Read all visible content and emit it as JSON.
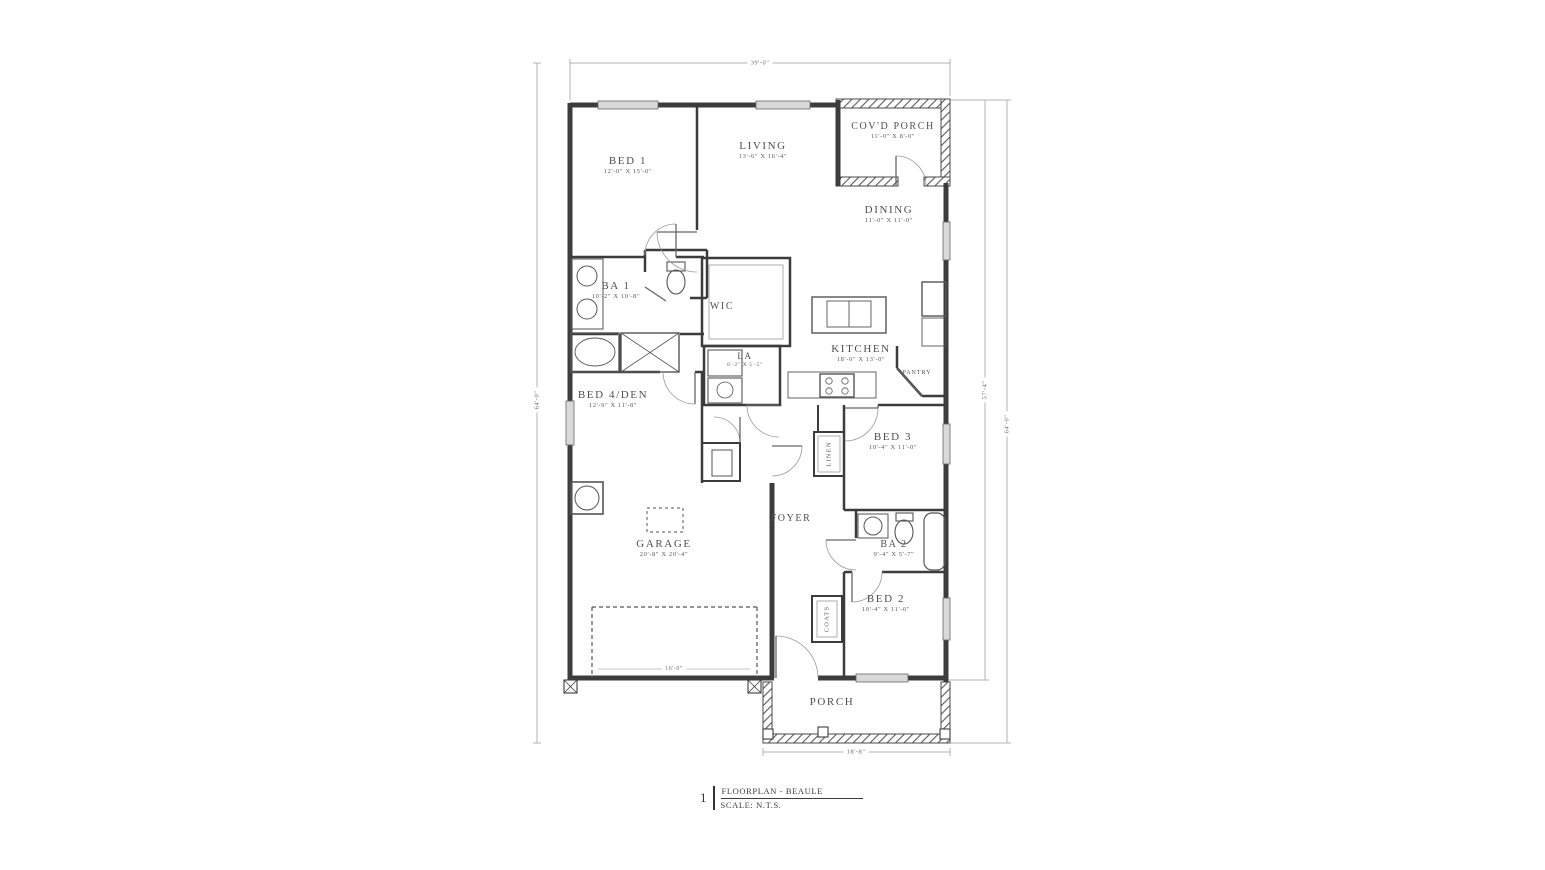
{
  "title_block": {
    "number": "1",
    "title": "FLOORPLAN - BEAULE",
    "scale": "SCALE: N.T.S."
  },
  "dimensions": {
    "top": "39'-0\"",
    "left": "64'-0\"",
    "right_inner": "57'-4\"",
    "right_outer": "64'-0\"",
    "porch_width": "18'-8\"",
    "garage_door": "16'-0\""
  },
  "rooms": {
    "bed1": {
      "name": "BED 1",
      "dims": "12'-0\" X 15'-0\""
    },
    "living": {
      "name": "LIVING",
      "dims": "13'-6\" X 16'-4\""
    },
    "covd_porch": {
      "name": "COV'D PORCH",
      "dims": "11'-0\" X 8'-0\""
    },
    "dining": {
      "name": "DINING",
      "dims": "11'-0\" X 11'-0\""
    },
    "ba1": {
      "name": "BA 1",
      "dims": "10'-2\" X 10'-8\""
    },
    "wic": {
      "name": "WIC"
    },
    "la": {
      "name": "LA",
      "dims": "6'-2\" X 5'-5\""
    },
    "kitchen": {
      "name": "KITCHEN",
      "dims": "18'-0\" X 13'-0\""
    },
    "pantry": {
      "name": "PANTRY"
    },
    "bed4": {
      "name": "BED 4/DEN",
      "dims": "12'-9\" X 11'-8\""
    },
    "bed3": {
      "name": "BED 3",
      "dims": "10'-4\" X 11'-0\""
    },
    "linen": {
      "name": "LINEN"
    },
    "foyer": {
      "name": "FOYER"
    },
    "garage": {
      "name": "GARAGE",
      "dims": "20'-8\" X 20'-4\""
    },
    "ba2": {
      "name": "BA 2",
      "dims": "9'-4\" X 5'-7\""
    },
    "bed2": {
      "name": "BED 2",
      "dims": "10'-4\" X 11'-0\""
    },
    "coats": {
      "name": "COATS"
    },
    "porch": {
      "name": "PORCH"
    }
  },
  "colors": {
    "wall": "#3c3c3c",
    "dim_line": "#b3b3b3",
    "window_fill": "#d9d9d9",
    "text": "#4a4a4a"
  }
}
